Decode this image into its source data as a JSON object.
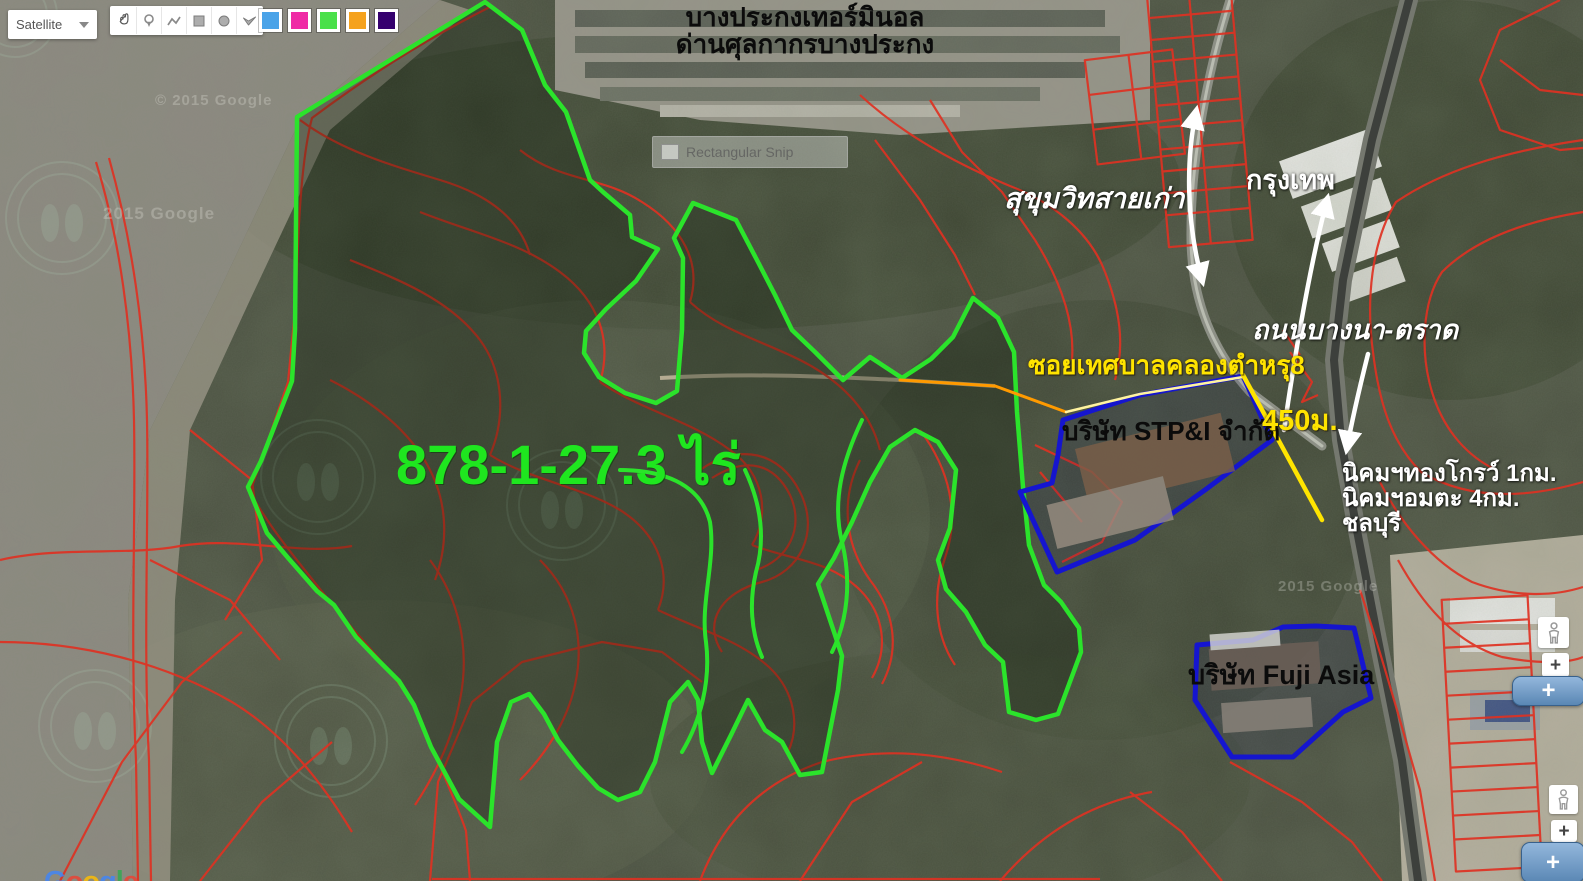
{
  "map_controls": {
    "map_type_label": "Satellite",
    "tools": [
      {
        "name": "pan"
      },
      {
        "name": "marker"
      },
      {
        "name": "polyline"
      },
      {
        "name": "rectangle"
      },
      {
        "name": "circle"
      },
      {
        "name": "polygon"
      }
    ],
    "swatches": [
      {
        "name": "blue",
        "color": "#4aa3e8"
      },
      {
        "name": "magenta",
        "color": "#ef2ba5"
      },
      {
        "name": "green",
        "color": "#4ae04a"
      },
      {
        "name": "orange",
        "color": "#f5a21d"
      },
      {
        "name": "purple",
        "color": "#35006e"
      }
    ]
  },
  "annotations": {
    "terminal_title_line1": "บางประกงเทอร์มินอล",
    "terminal_title_line2": "ด่านศุลกากรบางประกง",
    "road_old_sukhumvit": "สุขุมวิทสายเก่า",
    "to_bangkok": "กรุงเทพ",
    "road_bangna_trat": "ถนนบางนา-ตราด",
    "soi_name": "ซอยเทศบาลคลองตำหรุ8",
    "company_stp": "บริษัท STP&I จำกัด",
    "distance_450m": "450ม.",
    "poi_line1": "นิคมฯทองโกรว์ 1กม.",
    "poi_line2": "นิคมฯอมตะ 4กม.",
    "poi_line3": "ชลบุรี",
    "company_fuji": "บริษัท Fuji Asia",
    "land_area": "878-1-27.3 ไร่"
  },
  "watermarks": {
    "copyright1": "© 2015 Google",
    "copyright2": "2015 Google",
    "copyright3": "2015 Google"
  },
  "snip_overlay": {
    "label": "Rectangular Snip"
  },
  "zoom_controls": {
    "plus": "+"
  },
  "logo": {
    "text": "Google",
    "letter_colors": [
      "#4285F4",
      "#EA4335",
      "#FBBC05",
      "#4285F4",
      "#34A853",
      "#EA4335"
    ]
  },
  "colors": {
    "green": "#2be32b",
    "green-text": "#1fe61f",
    "red": "#df3222",
    "blue": "#1515cf",
    "yellow": "#ffe400",
    "orange": "#ff9a00"
  }
}
